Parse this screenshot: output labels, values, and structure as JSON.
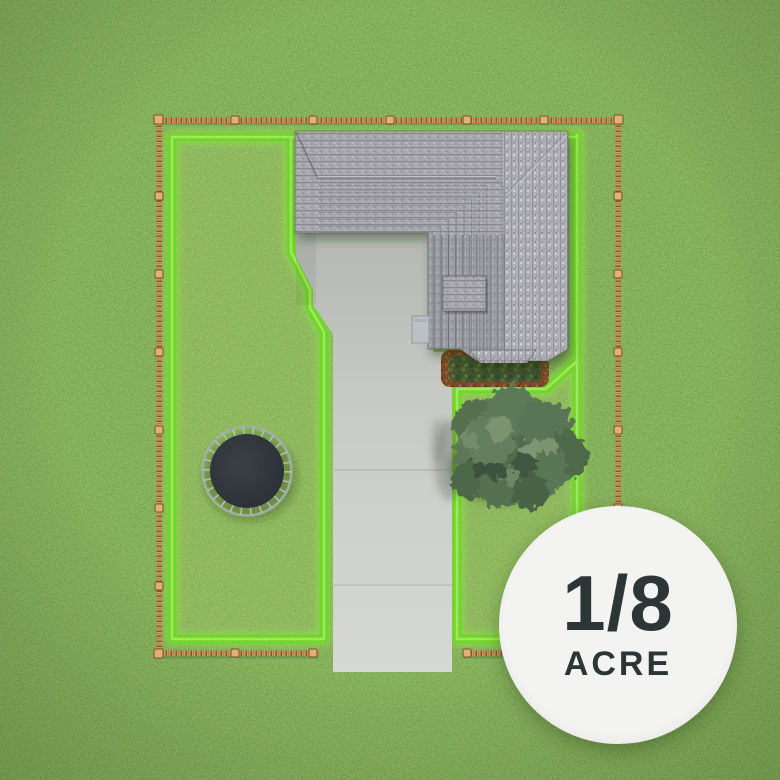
{
  "badge": {
    "fraction": "1/8",
    "unit": "ACRE"
  },
  "scene": {
    "view": "top-down aerial rendering of a residential lot",
    "objects": [
      "grass lawn",
      "wooden rope fence around lot",
      "bright green highlighted property boundary",
      "gray shingle roof house",
      "concrete driveway",
      "trampoline",
      "tree",
      "garden bed"
    ],
    "colors": {
      "grass": "#71a03f",
      "boundary_green": "#72d52c",
      "boundary_glow": "#9fe85e",
      "fence_wood": "#c49659",
      "roof_gray": "#a6a6ac",
      "roof_east_slope": "#b1b1b7",
      "driveway": "#c9ccc7",
      "trampoline_mat": "#31373d",
      "tree_green": "#5a7758",
      "garden_soil": "#7a4c27",
      "badge_background": "#f3f4f2",
      "badge_text": "#2d3537"
    }
  }
}
